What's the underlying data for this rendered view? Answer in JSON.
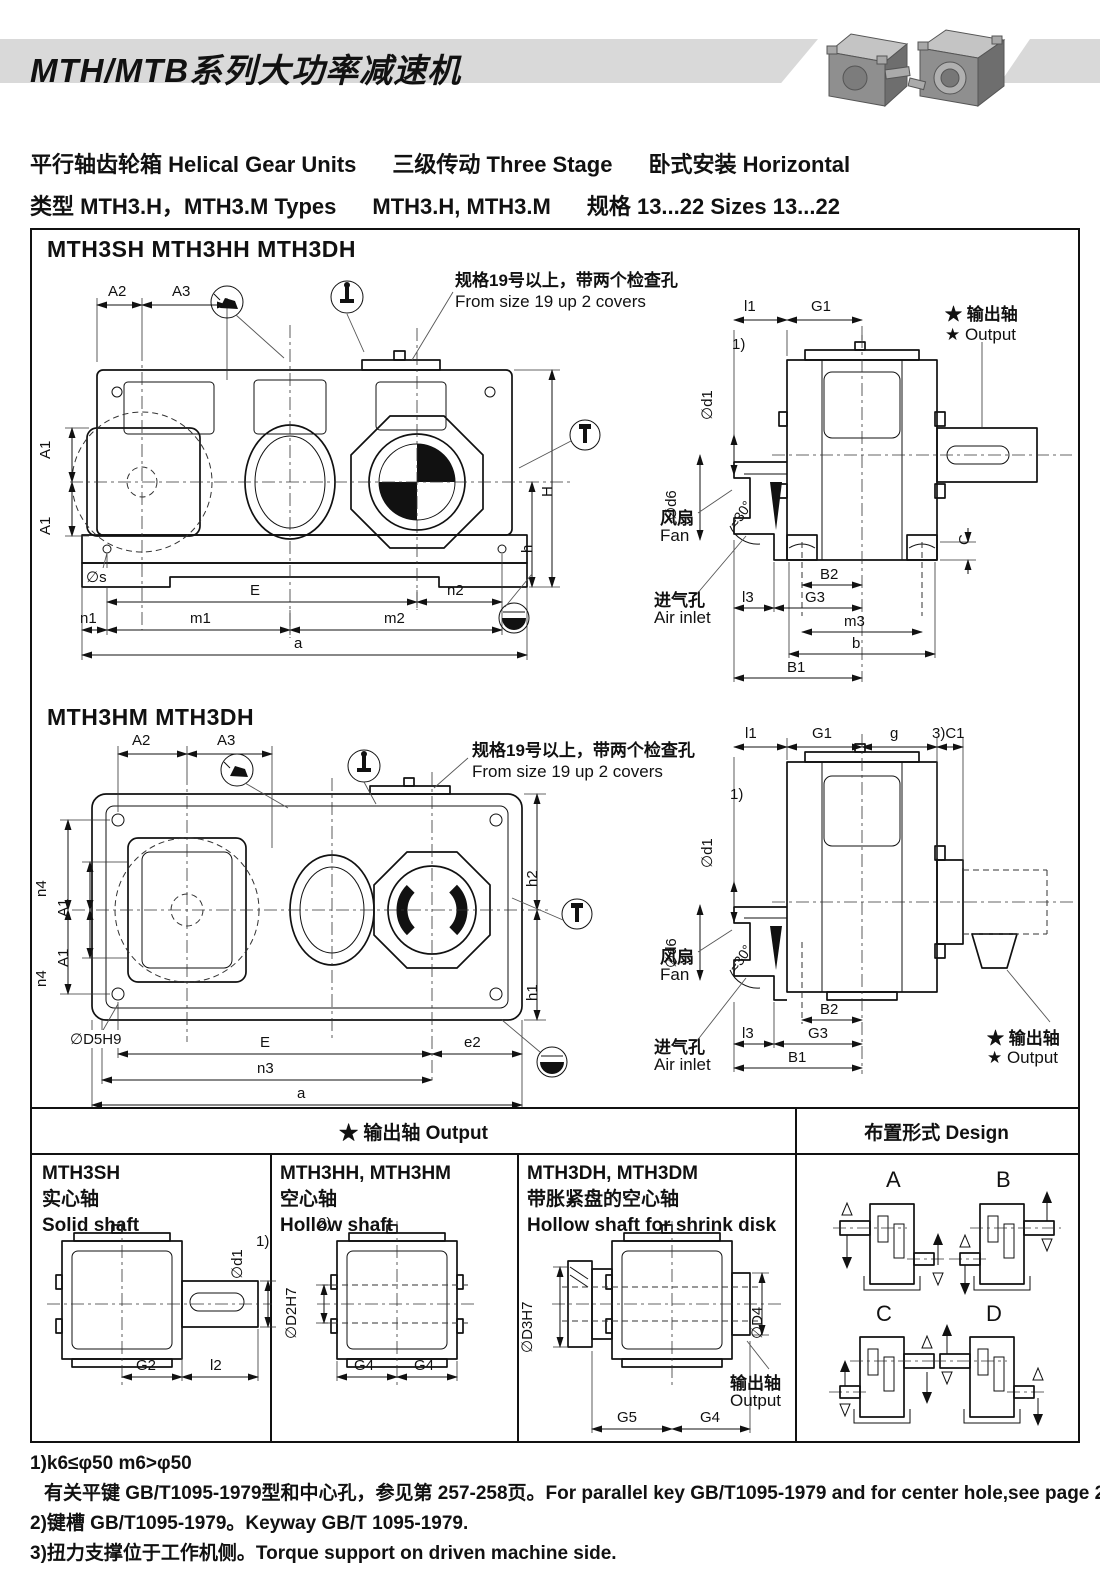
{
  "header": {
    "title": "MTH/MTB系列大功率减速机"
  },
  "intro": {
    "line1_seg1": "平行轴齿轮箱 Helical Gear Units",
    "line1_seg2": "三级传动 Three Stage",
    "line1_seg3": "卧式安装 Horizontal",
    "line2_seg1": "类型 MTH3.H，MTH3.M Types",
    "line2_seg2": "MTH3.H, MTH3.M",
    "line2_seg3": "规格 13...22 Sizes 13...22"
  },
  "sections": {
    "s1_title": "MTH3SH MTH3HH MTH3DH",
    "s2_title": "MTH3HM MTH3DH"
  },
  "common": {
    "note_cn": "规格19号以上，带两个检查孔",
    "note_en": "From size 19 up 2 covers",
    "out_cn": "★ 输出轴",
    "out_en": "★ Output",
    "fan_cn": "风扇",
    "fan_en": "Fan",
    "air_cn": "进气孔",
    "air_en": "Air inlet",
    "angle": "≈30°"
  },
  "dims": {
    "A1": "A1",
    "A2": "A2",
    "A3": "A3",
    "phi_s": "∅s",
    "E": "E",
    "n1": "n1",
    "n2": "n2",
    "m1": "m1",
    "m2": "m2",
    "a": "a",
    "H": "H",
    "h": "h",
    "l1": "l1",
    "G1": "G1",
    "phi_d1": "∅d1",
    "phi_d6": "∅d6",
    "ref1": "1)",
    "C": "C",
    "B2": "B2",
    "G3": "G3",
    "l3": "l3",
    "m3": "m3",
    "b": "b",
    "B1": "B1",
    "n4": "n4",
    "phi_D5H9": "∅D5H9",
    "e2": "e2",
    "n3": "n3",
    "h1": "h1",
    "h2": "h2",
    "g": "g",
    "C1": "3)C1",
    "G2": "G2",
    "l2": "l2",
    "ref2": "2)",
    "phi_D2H7": "∅D2H7",
    "G4": "G4",
    "G5": "G5",
    "phi_D3H7": "∅D3H7",
    "phi_D4": "∅D4"
  },
  "output_table": {
    "header_left": "★ 输出轴  Output",
    "header_right": "布置形式 Design",
    "col1": {
      "model": "MTH3SH",
      "cn": "实心轴",
      "en": "Solid shaft"
    },
    "col2": {
      "model": "MTH3HH, MTH3HM",
      "cn": "空心轴",
      "en": "Hollow shaft"
    },
    "col3": {
      "model": "MTH3DH, MTH3DM",
      "cn": "带胀紧盘的空心轴",
      "en": "Hollow shaft for shrink disk",
      "shaft_cn": "输出轴",
      "shaft_en": "Output"
    },
    "designs": [
      "A",
      "B",
      "C",
      "D"
    ]
  },
  "notes": {
    "line1": "1)k6≤φ50   m6>φ50",
    "line2": "有关平键 GB/T1095-1979型和中心孔，参见第 257-258页。For parallel key GB/T1095-1979 and for center hole,see page 257-258.",
    "line3": "2)键槽 GB/T1095-1979。Keyway GB/T 1095-1979.",
    "line4": "3)扭力支撑位于工作机侧。Torque support on driven machine side."
  },
  "colors": {
    "line": "#1a1a1a",
    "band": "#d9d9d9"
  }
}
